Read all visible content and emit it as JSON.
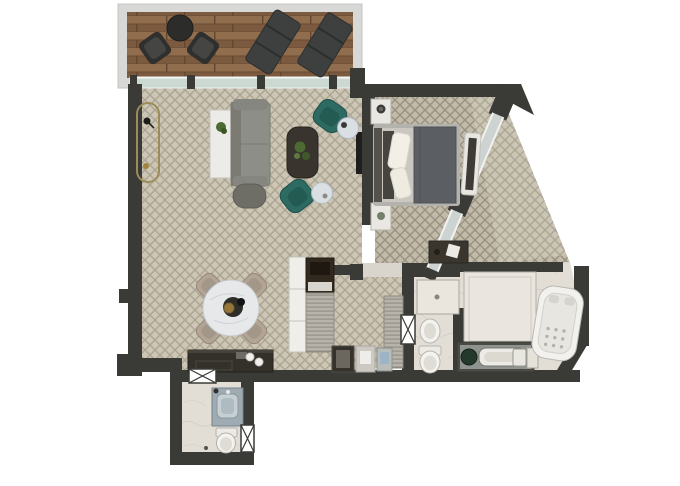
{
  "title": "hotel-suite-floor-plan",
  "palette": {
    "background": "#ffffff",
    "wall": "#3a3a37",
    "balcony_frame": "#d8d8d6",
    "deck_wood": "#846244",
    "glass": "#ccd9d3",
    "carpet_base": "#cdc6b4",
    "carpet_line": "#a59e8d",
    "bedroom_carpet_base": "#c2bbaa",
    "bedroom_carpet_line": "#948d7c",
    "marble": "#e2ded6",
    "fixture_white": "#f2f1ed",
    "sofa_gray": "#8e8e88",
    "ottoman_gray": "#6e6e67",
    "teal_chair": "#2c6a62",
    "coffee_table_dark": "#39342d",
    "console_white": "#edebe7",
    "gold_trim": "#9c8c5a",
    "blanket_gray": "#5b5f63",
    "mattress_gray": "#cac7c0",
    "pillow_white": "#f2efe7",
    "sideboard_dark": "#34312b",
    "dining_marble": "#e6e8ea",
    "chair_beige": "#b2a595",
    "louver_gray": "#b7b3aa",
    "vanity_blue": "#9fabb2",
    "counter_gray": "#8f938f",
    "plant_green": "#4d6a33",
    "outdoor_dark": "#2c2c2a",
    "lounger_gray": "#3e403f"
  },
  "rooms": [
    {
      "name": "balcony",
      "floor": "wood-deck",
      "furniture": [
        "round-bistro-table",
        "bistro-chair",
        "bistro-chair",
        "sun-lounger",
        "sun-lounger"
      ]
    },
    {
      "name": "living-room",
      "floor": "patterned-carpet",
      "furniture": [
        "writing-desk",
        "console-table",
        "sofa",
        "ottoman",
        "coffee-table",
        "potted-plant",
        "armchair",
        "armchair",
        "round-side-table",
        "round-side-table",
        "wall-tv"
      ]
    },
    {
      "name": "bedroom",
      "floor": "patterned-carpet",
      "furniture": [
        "double-bed",
        "pillows",
        "nightstand",
        "nightstand",
        "media-bench",
        "luggage-console"
      ]
    },
    {
      "name": "dining-area",
      "floor": "patterned-carpet",
      "furniture": [
        "round-dining-table",
        "dining-chair",
        "dining-chair",
        "dining-chair",
        "dining-chair",
        "sideboard"
      ]
    },
    {
      "name": "wardrobe-corridor",
      "floor": "patterned-carpet",
      "furniture": [
        "white-wardrobe",
        "minibar-cabinet",
        "louvered-closet",
        "louvered-closet",
        "minibar",
        "appliance",
        "appliance"
      ]
    },
    {
      "name": "shower-wc",
      "floor": "marble",
      "furniture": [
        "shower-zone",
        "bidet",
        "toilet",
        "door"
      ]
    },
    {
      "name": "master-bathroom",
      "floor": "marble",
      "furniture": [
        "walk-in-shower",
        "vanity-counter",
        "vessel-sink",
        "trough-sink",
        "jacuzzi-tub",
        "towel-unit"
      ]
    },
    {
      "name": "guest-bathroom",
      "floor": "marble",
      "furniture": [
        "vanity-sink",
        "toilet",
        "door",
        "door"
      ]
    }
  ],
  "windows": [
    "balcony-glass-wall",
    "bedroom-diagonal-window",
    "bedroom-diagonal-window-2"
  ],
  "doors": [
    "guest-bath-top-door",
    "guest-bath-entry-door",
    "wc-door"
  ]
}
